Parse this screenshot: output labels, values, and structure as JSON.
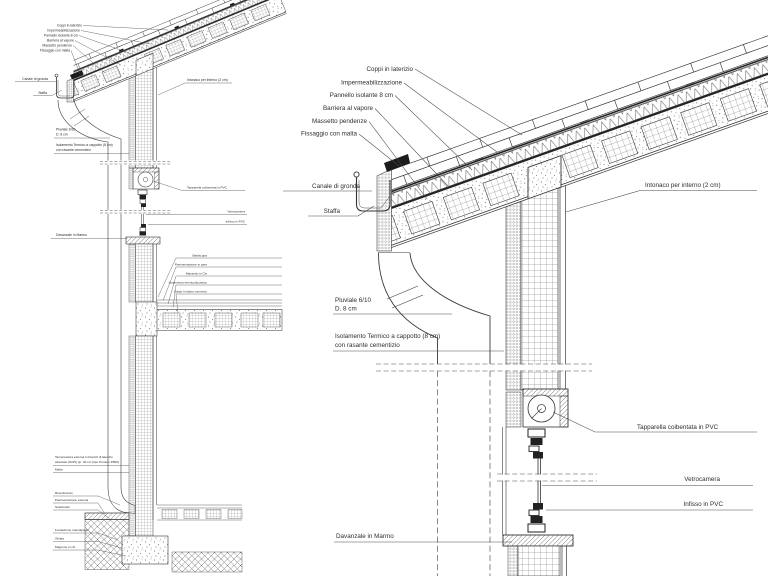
{
  "page": {
    "background": "#ffffff",
    "line_color": "#3a3a3a",
    "text_color": "#2e2e2e",
    "description": "Architectural construction detail drawing, roof-wall-window section, overview section left and enlarged eaves detail right"
  },
  "labels": {
    "coppi": "Coppi in laterizio",
    "impermeabilizzazione": "Impermeabilizzazione",
    "pannello_isolante": "Pannello isolante 8 cm",
    "barriera_vapore": "Barriera al vapore",
    "massetto_pendenze": "Massetto pendenze",
    "fissaggio_malta": "Fissaggio con malta",
    "canale_gronda": "Canale di gronda",
    "staffa": "Staffa",
    "intonaco_interno": "Intonaco per interno (2 cm)",
    "pluviale_riga1": "Pluviale 6/10",
    "pluviale_riga2": "D. 8 cm",
    "isolamento_riga1": "Isolamento Termico a cappotto (8 cm)",
    "isolamento_riga2": "con rasante cementizio",
    "tapparella": "Tapparella coibentata in PVC",
    "vetrocamera": "Vetrocamera",
    "infisso": "Infisso in PVC",
    "davanzale": "Davanzale in Marmo",
    "battiscopa": "Battiscopa",
    "pavimentazione_gres": "Pavimentazione in gres",
    "massetto_cls": "Massetto in Cls",
    "isolamento_acustico": "Isolamento termico/acustico",
    "solaio_laterocemento": "Solaio in latero-cemento",
    "tamponatura_riga1": "Tamponatura esterna in blocchi di laterizio",
    "tamponatura_riga2": "alveolato (8x25) sp. 30 cm (tipo Poroton P800)",
    "malta": "Malta",
    "rivestimento": "Rivestimento",
    "pavimentazione_esterna": "Pavimentazione esterna",
    "sottofondo": "Sottofondo",
    "fondazione_marciapiede": "Fondazione marciapiede",
    "ghiaia": "Ghiaia",
    "magrone": "Magrone in cls"
  }
}
